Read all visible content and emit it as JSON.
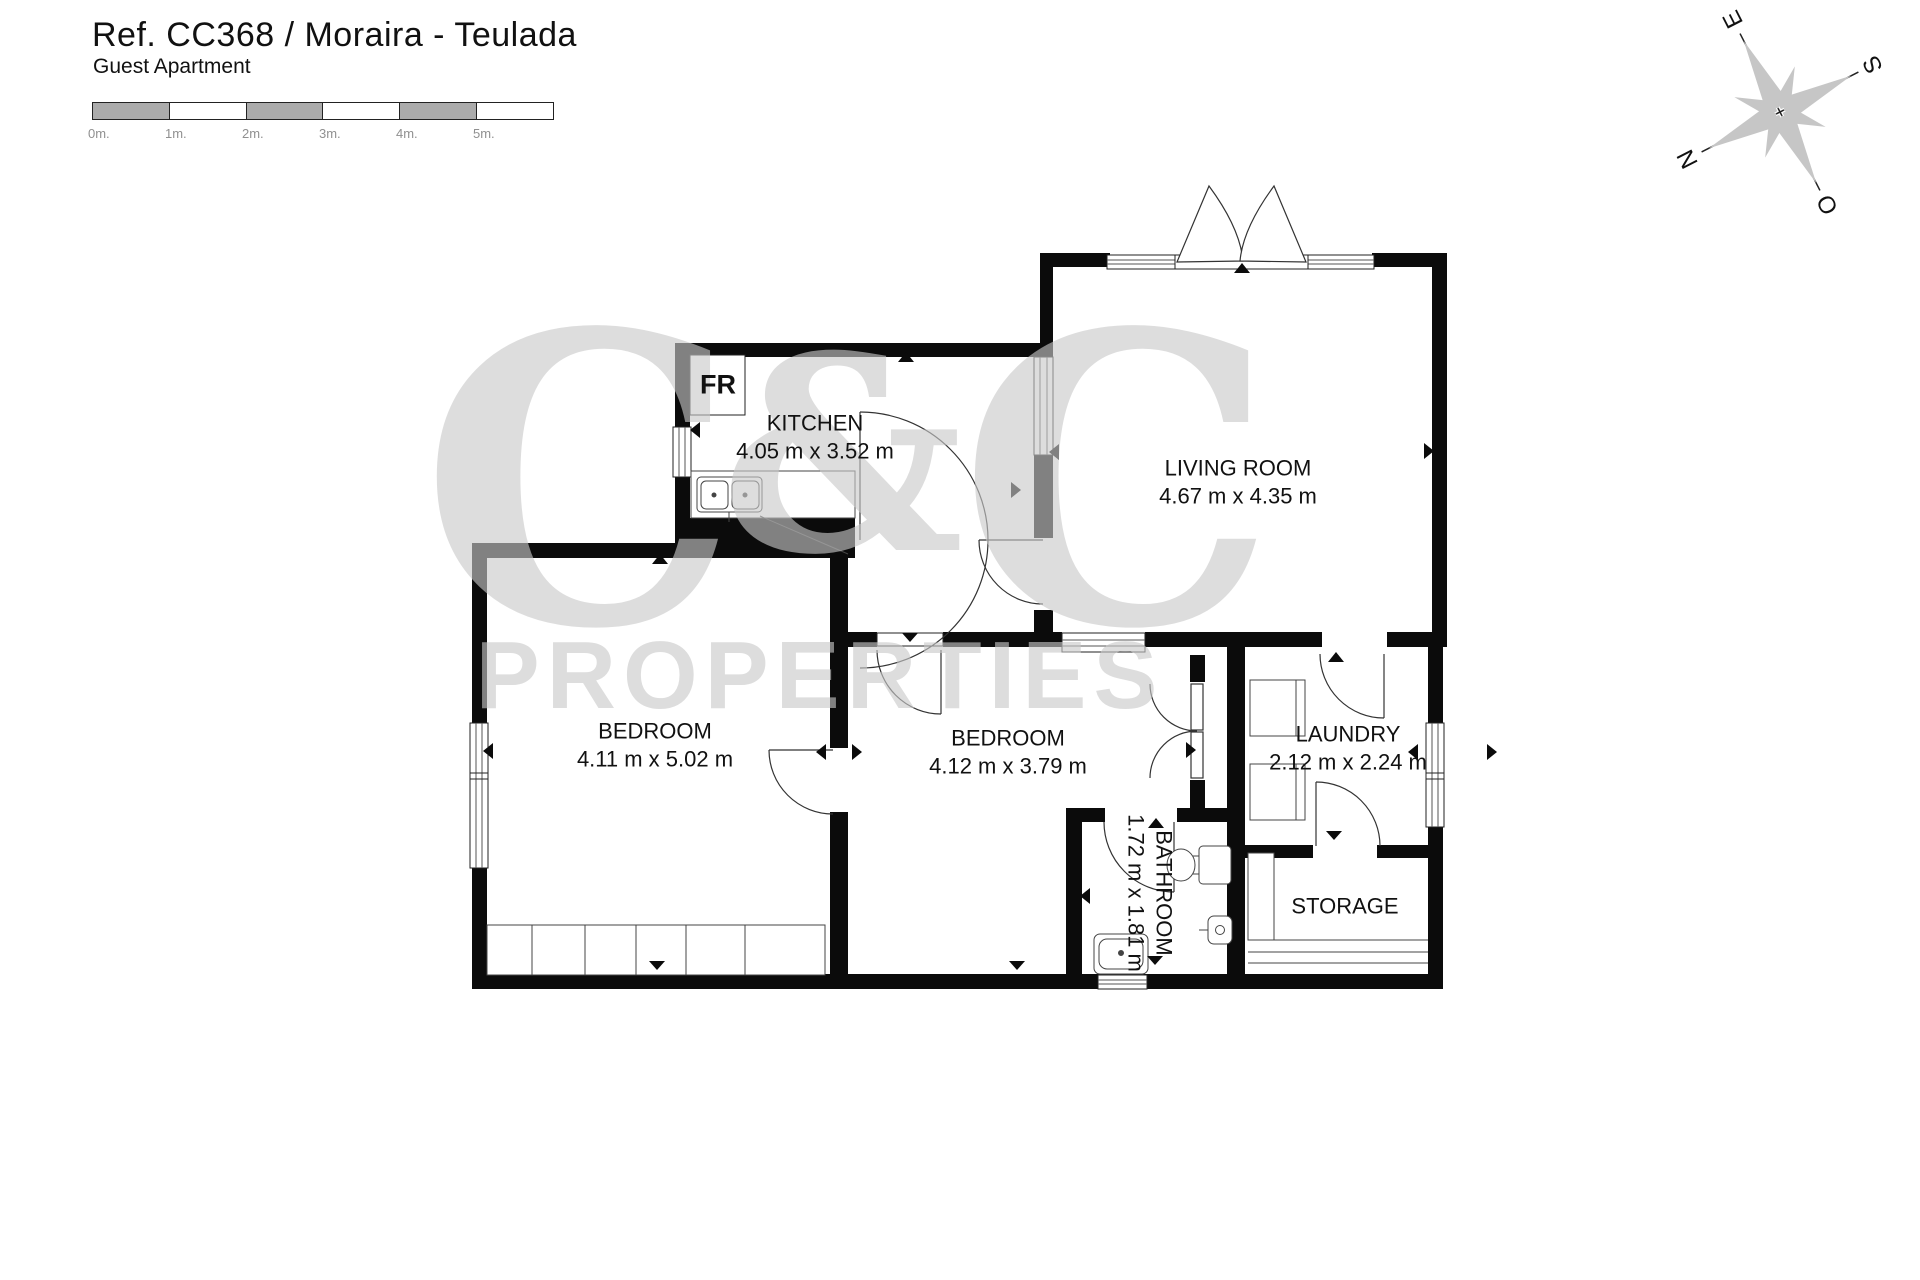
{
  "header": {
    "title": "Ref. CC368 / Moraira - Teulada",
    "subtitle": "Guest Apartment"
  },
  "scale_bar": {
    "labels": [
      "0m.",
      "1m.",
      "2m.",
      "3m.",
      "4m.",
      "5m."
    ]
  },
  "compass": {
    "n": "N",
    "s": "S",
    "e": "E",
    "w": "O"
  },
  "watermark": {
    "line1_c1": "C",
    "line1_amp": "&",
    "line1_c2": "C",
    "line2": "PROPERTIES"
  },
  "appliances": {
    "fridge": "FR"
  },
  "rooms": {
    "kitchen": {
      "name": "KITCHEN",
      "dims": "4.05 m x 3.52 m"
    },
    "living_room": {
      "name": "LIVING ROOM",
      "dims": "4.67 m x 4.35 m"
    },
    "bedroom_left": {
      "name": "BEDROOM",
      "dims": "4.11 m x 5.02 m"
    },
    "bedroom_mid": {
      "name": "BEDROOM",
      "dims": "4.12 m x 3.79 m"
    },
    "laundry": {
      "name": "LAUNDRY",
      "dims": "2.12 m x 2.24 m"
    },
    "bathroom": {
      "name": "BATHROOM",
      "dims": "1.72 m x 1.81 m"
    },
    "storage": {
      "name": "STORAGE"
    }
  },
  "colors": {
    "wall": "#0b0b0b",
    "watermark": "#c9c9c9",
    "scale_gray": "#ababab"
  }
}
